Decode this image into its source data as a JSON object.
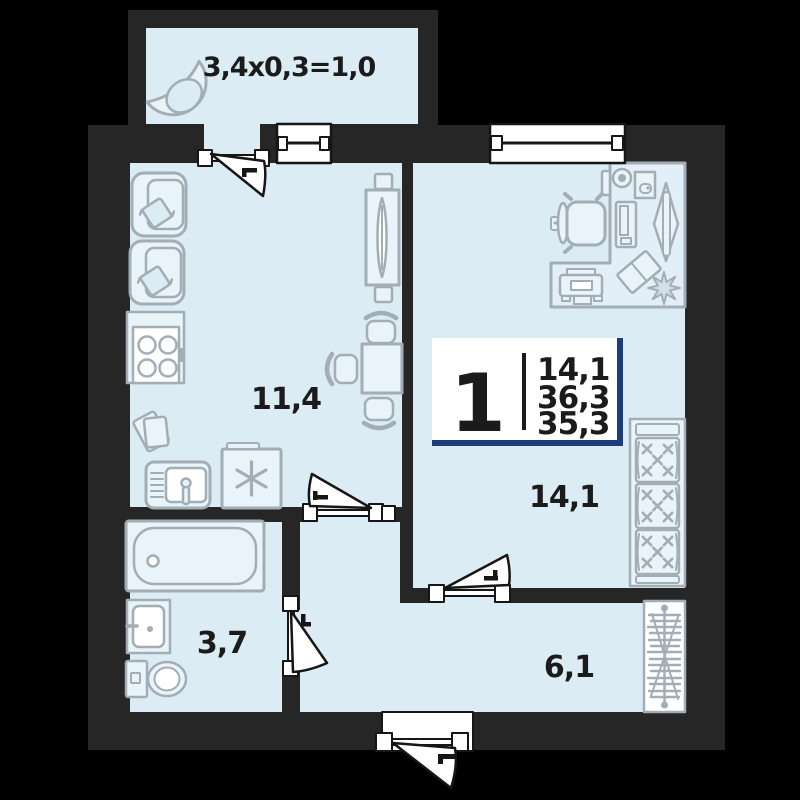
{
  "plan": {
    "balcony_label": "3,4x0,3=1,0",
    "rooms": {
      "kitchen_living": {
        "area": "11,4"
      },
      "bedroom": {
        "area": "14,1"
      },
      "bathroom": {
        "area": "3,7"
      },
      "hallway": {
        "area": "6,1"
      }
    },
    "info_badge": {
      "rooms_count": "1",
      "living_area": "14,1",
      "total_area": "36,3",
      "area_no_balcony": "35,3"
    },
    "colors": {
      "background": "#000000",
      "walls": "#262626",
      "floor": "#dbecf5",
      "furniture_stroke": "#a3adb5",
      "badge_accent": "#1e3d7c",
      "label_text": "#1b1b1b"
    }
  }
}
